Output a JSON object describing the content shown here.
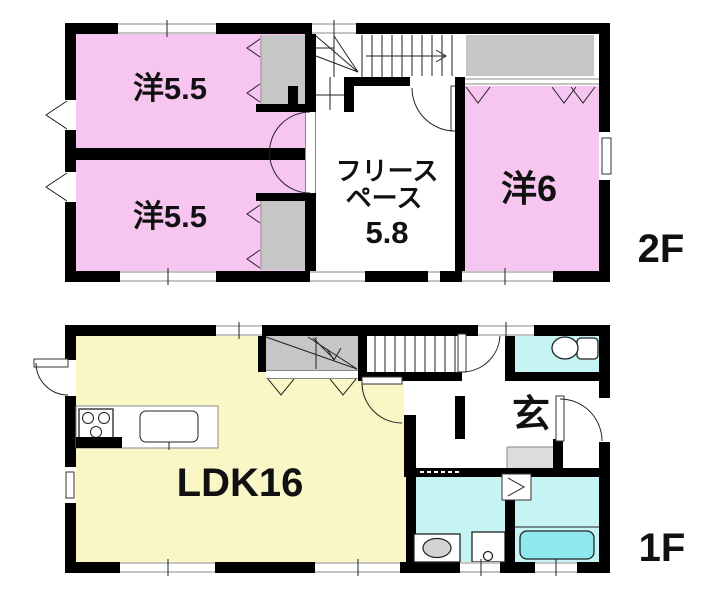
{
  "colors": {
    "room_pink": "#F7C6F0",
    "room_yellow": "#FAF7C6",
    "room_cyan": "#C6F3F4",
    "tub_cyan": "#8FE9EC",
    "closet_gray": "#C6C6C6",
    "step_gray": "#DCDCDC",
    "wall_black": "#000000",
    "white": "#FFFFFF"
  },
  "floor_2f": {
    "floor_label": "2F",
    "rooms": {
      "west_room_1": {
        "label": "洋5.5"
      },
      "west_room_2": {
        "label": "洋5.5"
      },
      "free_space": {
        "label_line1": "フリース",
        "label_line2": "ペース",
        "size": "5.8"
      },
      "west_room_3": {
        "label": "洋6"
      }
    }
  },
  "floor_1f": {
    "floor_label": "1F",
    "rooms": {
      "ldk": {
        "label": "LDK16"
      },
      "entrance": {
        "label": "玄"
      }
    }
  }
}
